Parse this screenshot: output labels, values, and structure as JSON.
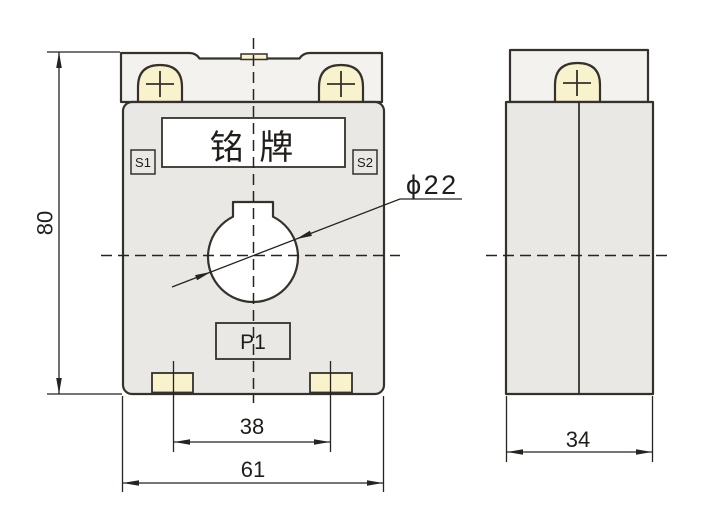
{
  "front_view": {
    "nameplate_label": "铭 牌",
    "terminal_s1_label": "S1",
    "terminal_s2_label": "S2",
    "p1_label": "P1"
  },
  "dimensions": {
    "height_label": "80",
    "overall_width_label": "61",
    "foot_spacing_label": "38",
    "depth_label": "34",
    "aperture_diameter_label": "ϕ22"
  },
  "colors": {
    "line": "#35312c",
    "dim_line": "#262321",
    "cap_fill": "#f3f2ee",
    "body_fill": "#e9e8e4",
    "accent_cream": "#f8f3cc",
    "white": "#ffffff"
  }
}
